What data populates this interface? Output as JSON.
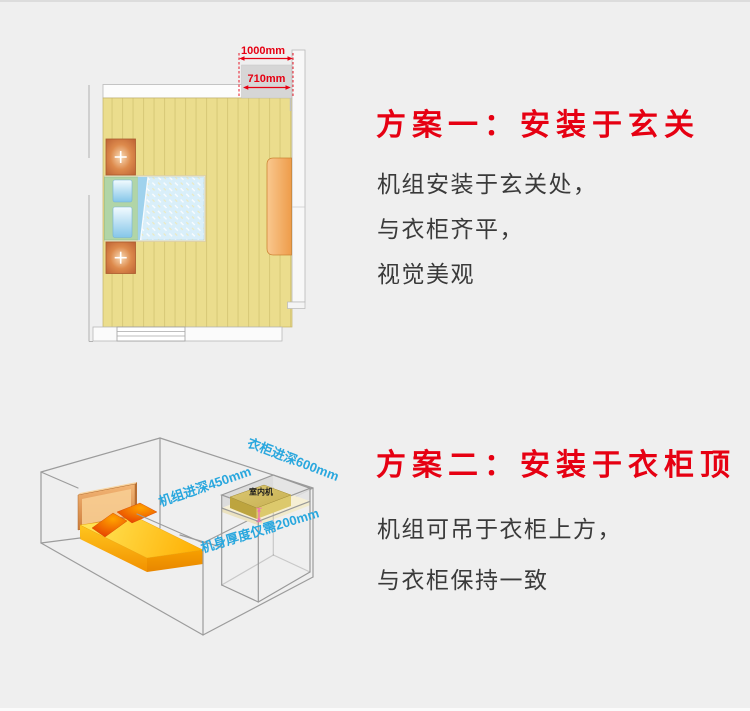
{
  "colors": {
    "background": "#efefef",
    "accent_red": "#e60012",
    "label_blue": "#29a7de",
    "body_text": "#3a3a3a"
  },
  "plan1": {
    "title": "方案一：安装于玄关",
    "description_lines": [
      "机组安装于玄关处，",
      "与衣柜齐平，",
      "视觉美观"
    ],
    "dimensions": {
      "entry_width": "1000mm",
      "unit_width": "710mm"
    }
  },
  "plan2": {
    "title": "方案二：安装于衣柜顶",
    "description_lines": [
      "机组可吊于衣柜上方，",
      "与衣柜保持一致"
    ],
    "labels": {
      "wardrobe_depth": "衣柜进深600mm",
      "unit_depth": "机组进深450mm",
      "unit_thickness": "机身厚度仅需200mm",
      "indoor_unit": "室内机"
    }
  }
}
